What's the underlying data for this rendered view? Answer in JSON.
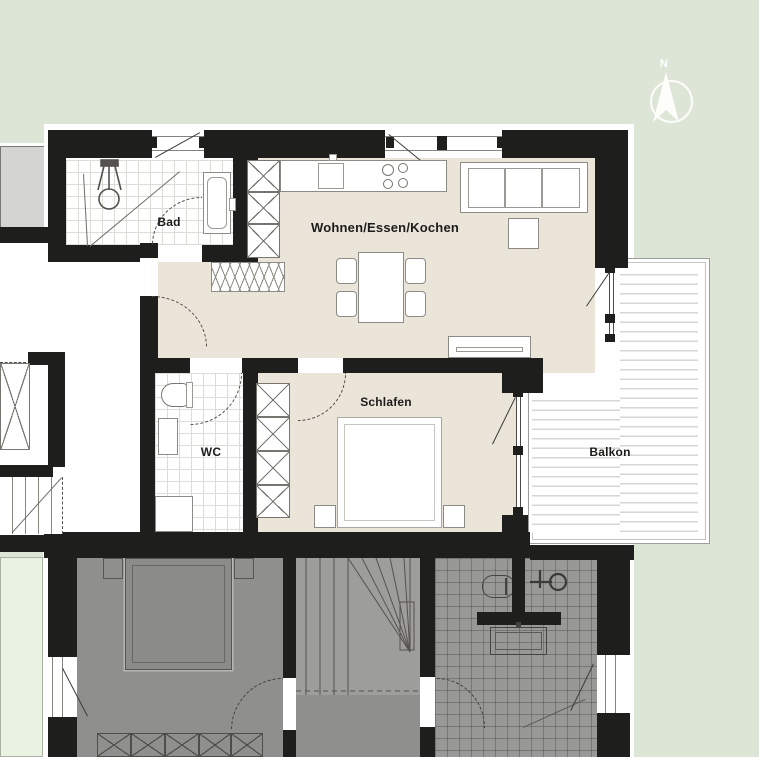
{
  "meta": {
    "type": "apartment-floor-plan"
  },
  "compass": {
    "north_label": "N"
  },
  "rooms": {
    "bad": {
      "label": "Bad"
    },
    "wohnen": {
      "label": "Wohnen/Essen/Kochen"
    },
    "wc": {
      "label": "WC"
    },
    "schlafen": {
      "label": "Schlafen"
    },
    "balkon": {
      "label": "Balkon"
    }
  },
  "colors": {
    "background": "#dce5d6",
    "active_floor": "#ebe5d9",
    "wall": "#1e1e1c",
    "white": "#ffffff",
    "inactive_floor": "#8f8f8d",
    "balcony_strip": "#eaf2e4",
    "neighbor_block": "#d4d4d2"
  }
}
